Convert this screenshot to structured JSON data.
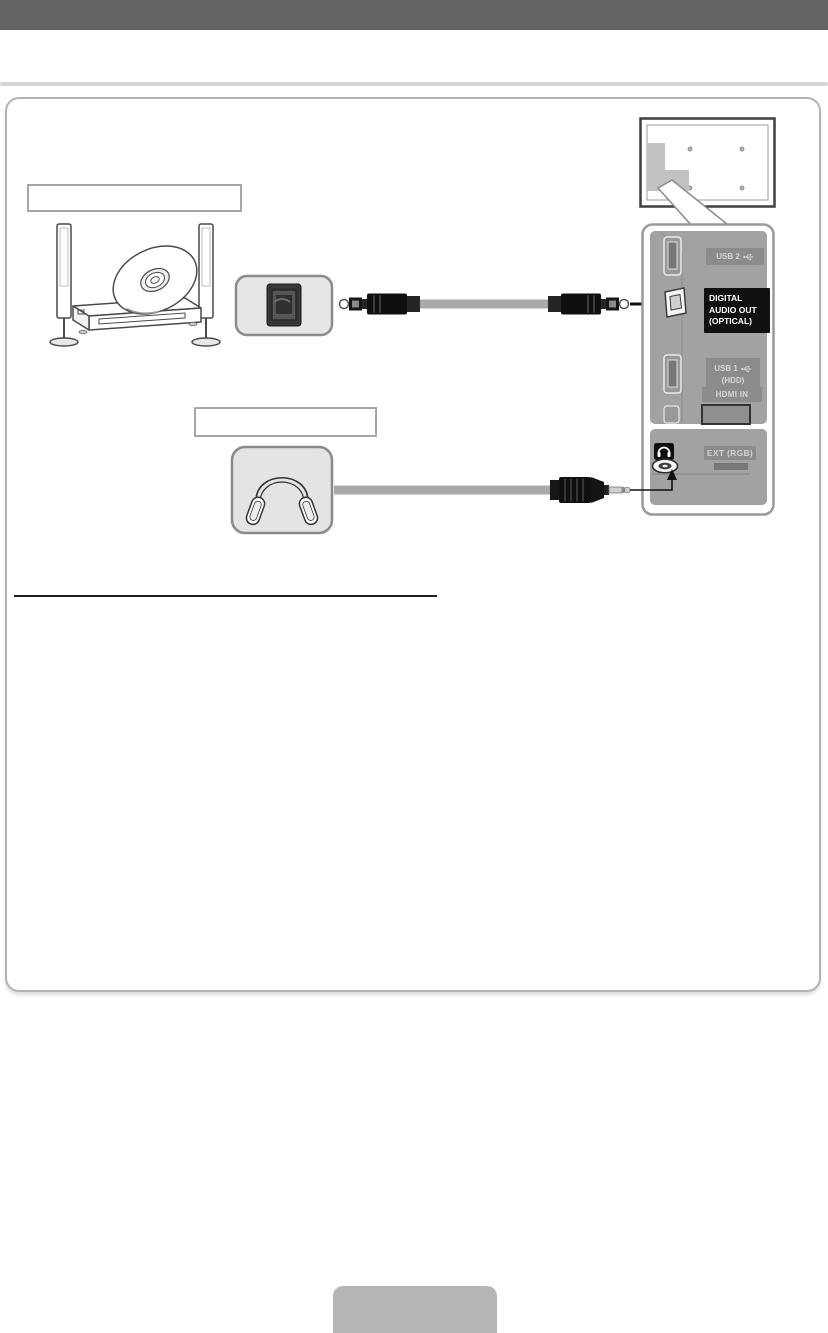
{
  "page": {
    "type": "tv-manual-connection-diagram",
    "header_text": ""
  },
  "device_labels": {
    "label_1": "",
    "label_2": ""
  },
  "panel": {
    "usb2": "USB 2",
    "digital_audio": [
      "DIGITAL",
      "AUDIO OUT",
      "(OPTICAL)"
    ],
    "usb1_line1": "USB 1",
    "usb1_line2": "(HDD)",
    "hdmi": "HDMI IN",
    "ext": "EXT (RGB)"
  },
  "icons": {
    "usb": "usb-trident-icon",
    "headphones_port": "headphones-icon",
    "optical_in": "optical-port-icon",
    "headphone_jack": "jack-3-5mm-icon",
    "arrow_right": "arrow-right-icon",
    "arrow_up": "arrow-up-icon"
  },
  "colors": {
    "header_bar": "#646464",
    "panel_gray": "#a2a2a2",
    "badge_gray": "#8b8b8b",
    "badge_black": "#111111",
    "device_box_fill": "#e6e6e6",
    "cable_gray": "#a9a9a9",
    "bottom_tab_gray": "#b5b5b5"
  }
}
